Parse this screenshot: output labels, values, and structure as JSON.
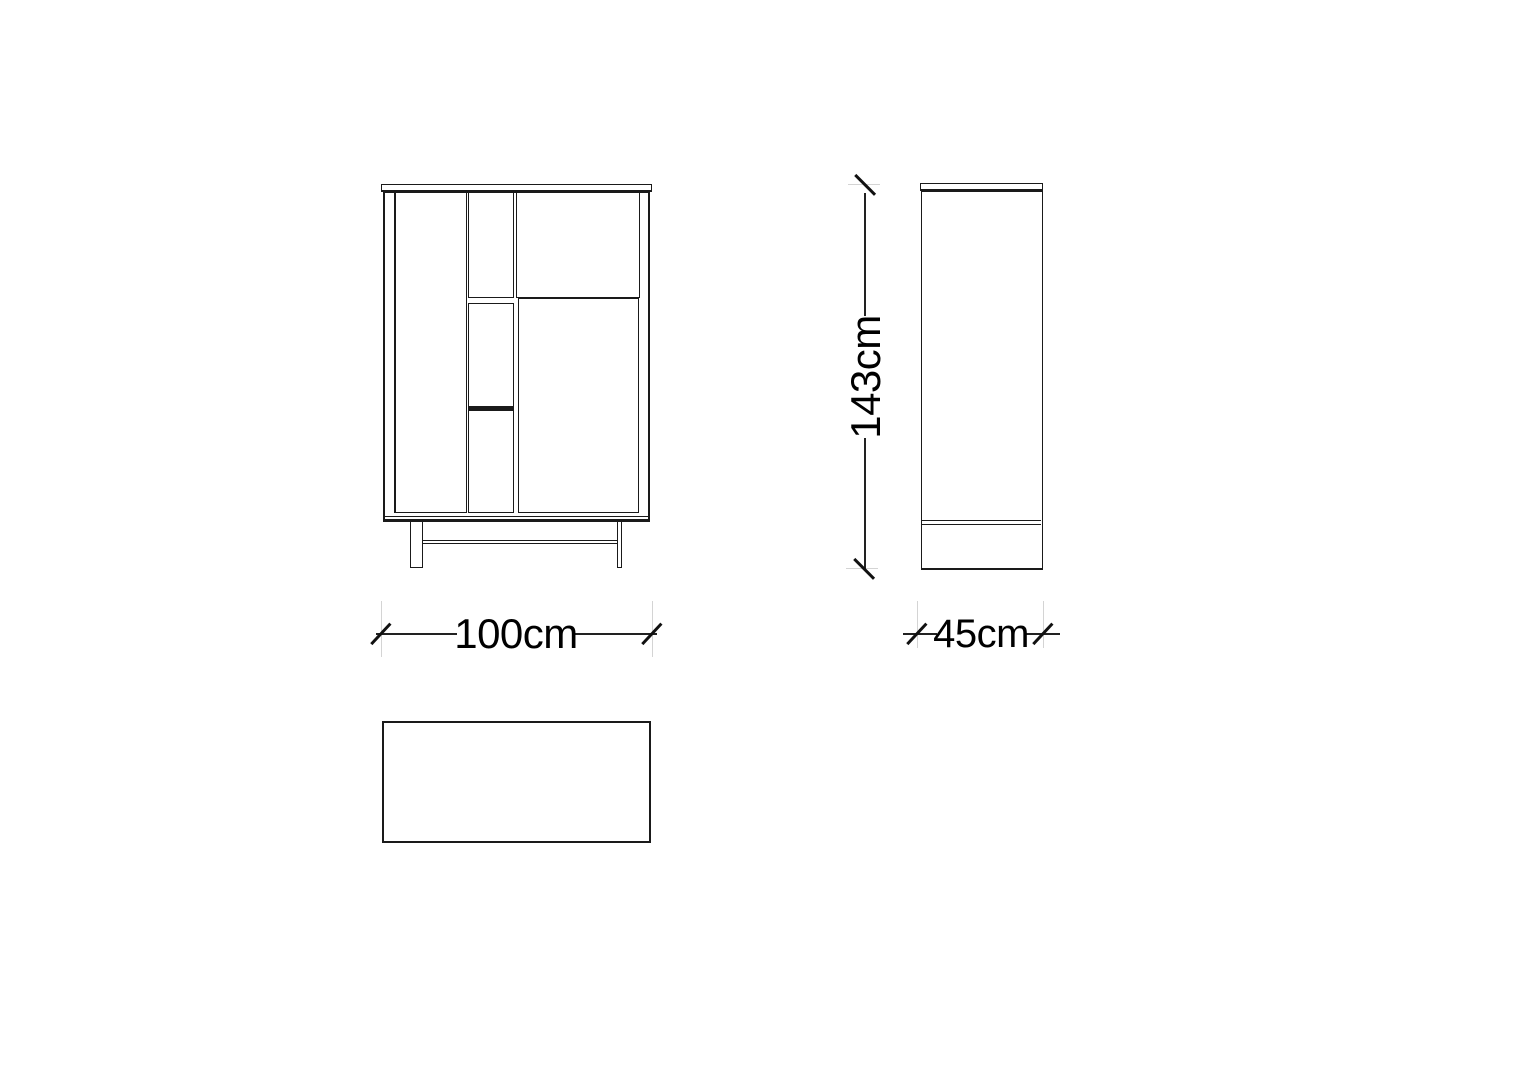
{
  "drawing": {
    "views": [
      {
        "id": "front-view",
        "description": "front elevation of cabinet with left door, three center drawers, top right drawer, right door, two legs and stretcher"
      },
      {
        "id": "side-view",
        "description": "side elevation with top panel and lower divider"
      },
      {
        "id": "top-view",
        "description": "plan view rectangle"
      }
    ],
    "dimensions": {
      "width": {
        "label": "100cm"
      },
      "depth": {
        "label": "45cm"
      },
      "height": {
        "label": "143cm"
      }
    }
  },
  "style_colors": {
    "line": "#1a1a1a",
    "dimension_line": "#222222",
    "extension_line": "#d4d4d4",
    "background": "#ffffff",
    "text": "#000000"
  }
}
